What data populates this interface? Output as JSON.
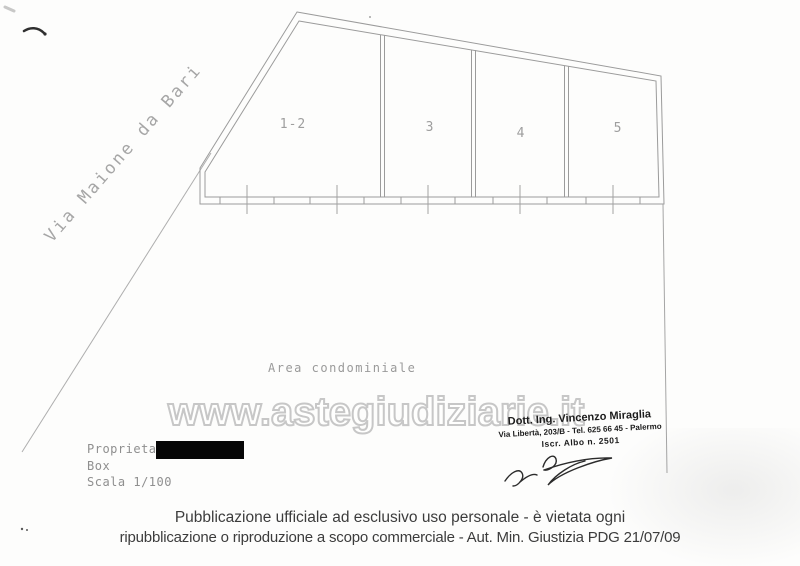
{
  "plan": {
    "street_label": "Via Maione da Bari",
    "area_label": "Area condominiale",
    "boxes": [
      "1-2",
      "3",
      "4",
      "5"
    ],
    "info": {
      "property": "Proprieta'",
      "type": "Box",
      "scale": "Scala 1/100"
    }
  },
  "watermark": {
    "text": "www.astegiudiziarie.it"
  },
  "stamp": {
    "name": "Dott. Ing. Vincenzo Miraglia",
    "address": "Via Libertà, 203/B - Tel. 625 66 45 - Palermo",
    "registration": "Iscr. Albo n. 2501"
  },
  "footer": {
    "line1": "Pubblicazione ufficiale ad esclusivo uso personale - è vietata ogni",
    "line2": "ripubblicazione o riproduzione a scopo commerciale - Aut. Min. Giustizia PDG 21/07/09"
  },
  "colors": {
    "drawing_line": "#9b9b9b",
    "cad_text": "#9a9a9a",
    "watermark_stroke": "#c7c7c7",
    "stamp_text": "#1b1b1b",
    "footer_text": "#3c3c3c",
    "redaction": "#060606"
  }
}
